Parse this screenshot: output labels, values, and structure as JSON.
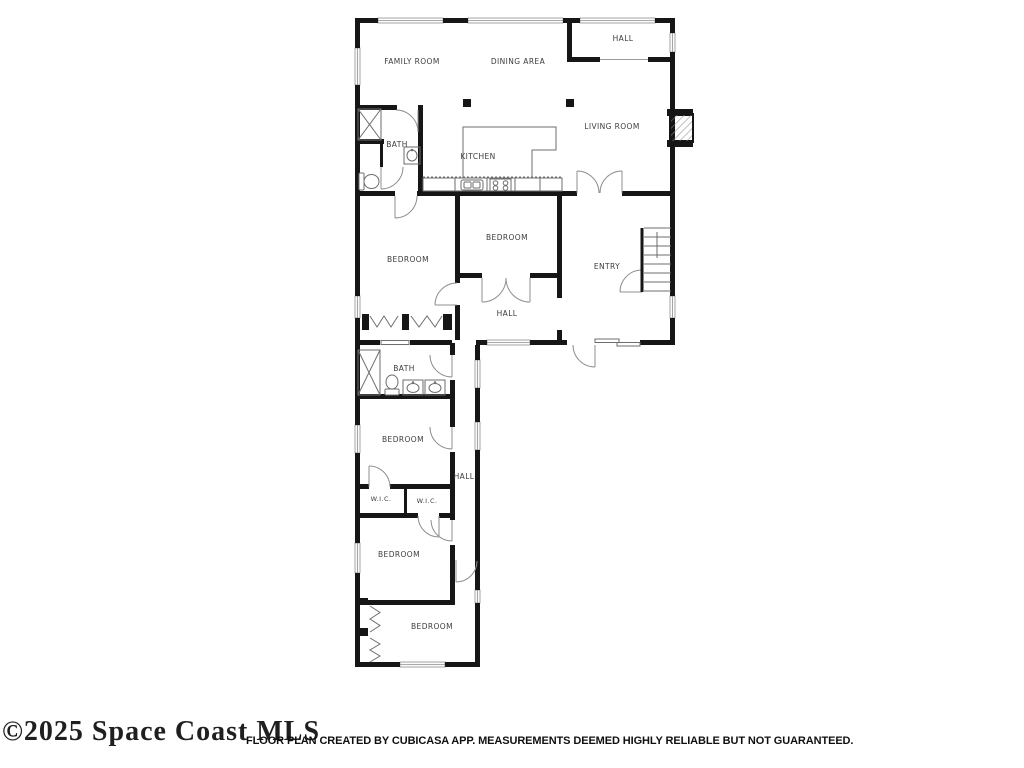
{
  "page": {
    "background": "#ffffff",
    "watermark": "©2025 Space Coast MLS",
    "disclaimer": "FLOOR PLAN CREATED BY CUBICASA APP. MEASUREMENTS DEEMED HIGHLY RELIABLE BUT NOT GUARANTEED."
  },
  "floor_plan": {
    "colors": {
      "wall": "#161616",
      "label_text": "#3d3d3d",
      "window_stroke": "#8f8f8f",
      "fixture_stroke": "#6e6e6e",
      "background": "#ffffff"
    },
    "fixture_icons": [
      "shower-icon",
      "toilet-icon",
      "sink-icon",
      "double-vanity-icon",
      "stove-icon",
      "kitchen-sink-icon",
      "stairs-icon",
      "fireplace-icon",
      "closet-bifold-icon"
    ],
    "rooms": [
      {
        "label": "FAMILY ROOM"
      },
      {
        "label": "DINING AREA"
      },
      {
        "label": "HALL"
      },
      {
        "label": "LIVING ROOM"
      },
      {
        "label": "KITCHEN"
      },
      {
        "label": "BATH"
      },
      {
        "label": "BEDROOM"
      },
      {
        "label": "BEDROOM"
      },
      {
        "label": "ENTRY"
      },
      {
        "label": "HALL"
      },
      {
        "label": "BATH"
      },
      {
        "label": "BEDROOM"
      },
      {
        "label": "HALL"
      },
      {
        "label": "W.I.C."
      },
      {
        "label": "W.I.C."
      },
      {
        "label": "BEDROOM"
      },
      {
        "label": "BEDROOM"
      }
    ]
  }
}
